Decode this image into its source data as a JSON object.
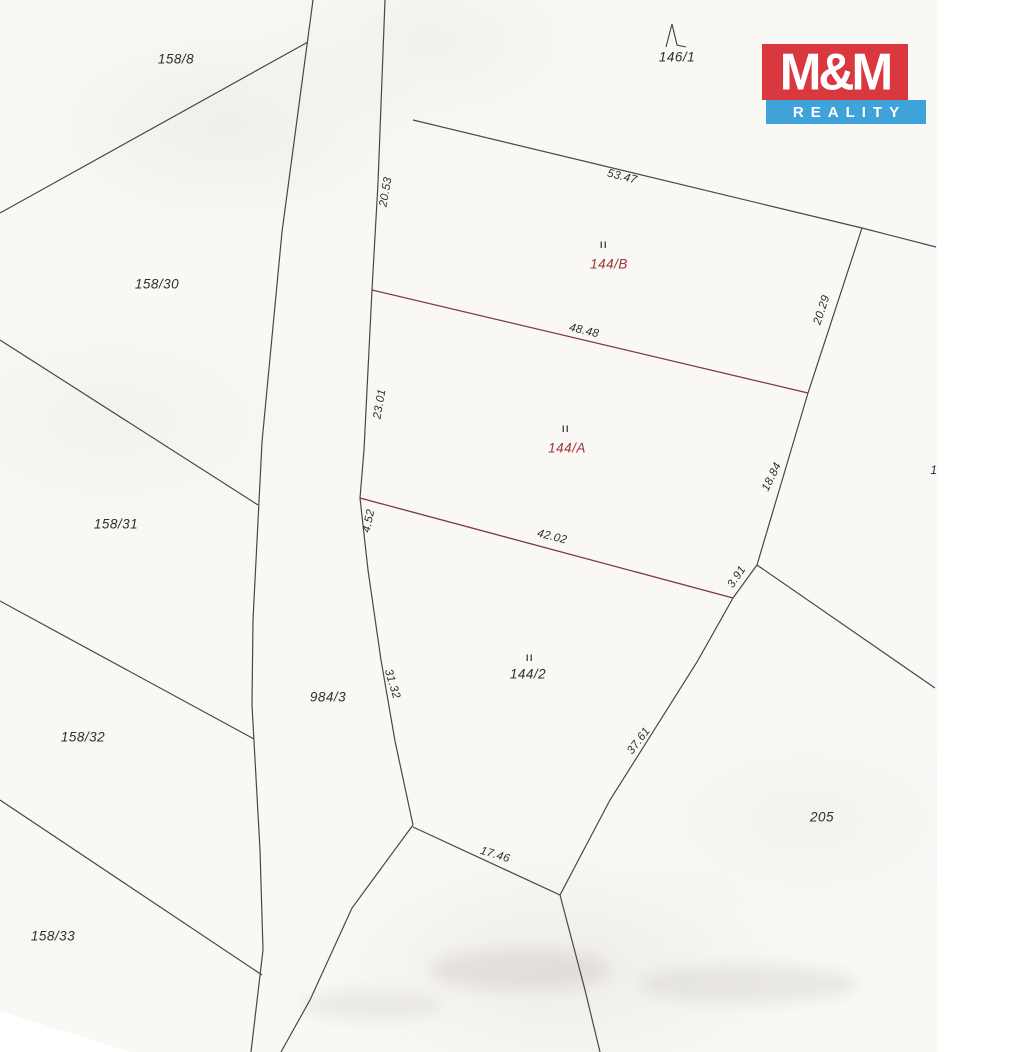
{
  "logo": {
    "top": "M&M",
    "bottom": "REALITY"
  },
  "colors": {
    "line": "#474747",
    "red_line": "#7d3939",
    "label": "#2e2e2e",
    "red_label": "#9c3336",
    "logo_red": "#d8383e",
    "logo_blue": "#3fa3d9"
  },
  "map": {
    "parcels": [
      {
        "text": "158/8",
        "x": 176,
        "y": 59,
        "color": "black"
      },
      {
        "text": "146/1",
        "x": 677,
        "y": 57,
        "color": "black"
      },
      {
        "text": "158/30",
        "x": 157,
        "y": 284,
        "color": "black"
      },
      {
        "text": "158/31",
        "x": 116,
        "y": 524,
        "color": "black"
      },
      {
        "text": "158/32",
        "x": 83,
        "y": 737,
        "color": "black"
      },
      {
        "text": "158/33",
        "x": 53,
        "y": 936,
        "color": "black"
      },
      {
        "text": "984/3",
        "x": 328,
        "y": 697,
        "color": "black"
      },
      {
        "text": "205",
        "x": 822,
        "y": 817,
        "color": "black"
      },
      {
        "text": "144/B",
        "x": 609,
        "y": 264,
        "color": "red"
      },
      {
        "text": "144/A",
        "x": 567,
        "y": 448,
        "color": "red"
      },
      {
        "text": "144/2",
        "x": 528,
        "y": 674,
        "color": "black"
      }
    ],
    "measurements": [
      {
        "text": "20.53",
        "x": 386,
        "y": 192,
        "rot": -80
      },
      {
        "text": "53.47",
        "x": 622,
        "y": 177,
        "rot": 14
      },
      {
        "text": "48.48",
        "x": 584,
        "y": 331,
        "rot": 13
      },
      {
        "text": "20.29",
        "x": 822,
        "y": 310,
        "rot": -72
      },
      {
        "text": "23.01",
        "x": 380,
        "y": 404,
        "rot": -80
      },
      {
        "text": "4.52",
        "x": 369,
        "y": 521,
        "rot": -78
      },
      {
        "text": "42.02",
        "x": 552,
        "y": 537,
        "rot": 14
      },
      {
        "text": "18.84",
        "x": 772,
        "y": 477,
        "rot": -64
      },
      {
        "text": "3.91",
        "x": 737,
        "y": 577,
        "rot": -56
      },
      {
        "text": "31.32",
        "x": 392,
        "y": 684,
        "rot": 73
      },
      {
        "text": "37.61",
        "x": 639,
        "y": 741,
        "rot": -53
      },
      {
        "text": "17.46",
        "x": 495,
        "y": 855,
        "rot": 17
      }
    ],
    "landuse_symbols": [
      {
        "text": "II",
        "x": 604,
        "y": 245
      },
      {
        "text": "II",
        "x": 566,
        "y": 429
      },
      {
        "text": "II",
        "x": 530,
        "y": 658
      }
    ],
    "edge_label": {
      "text": "1",
      "x": 934,
      "y": 470
    }
  }
}
